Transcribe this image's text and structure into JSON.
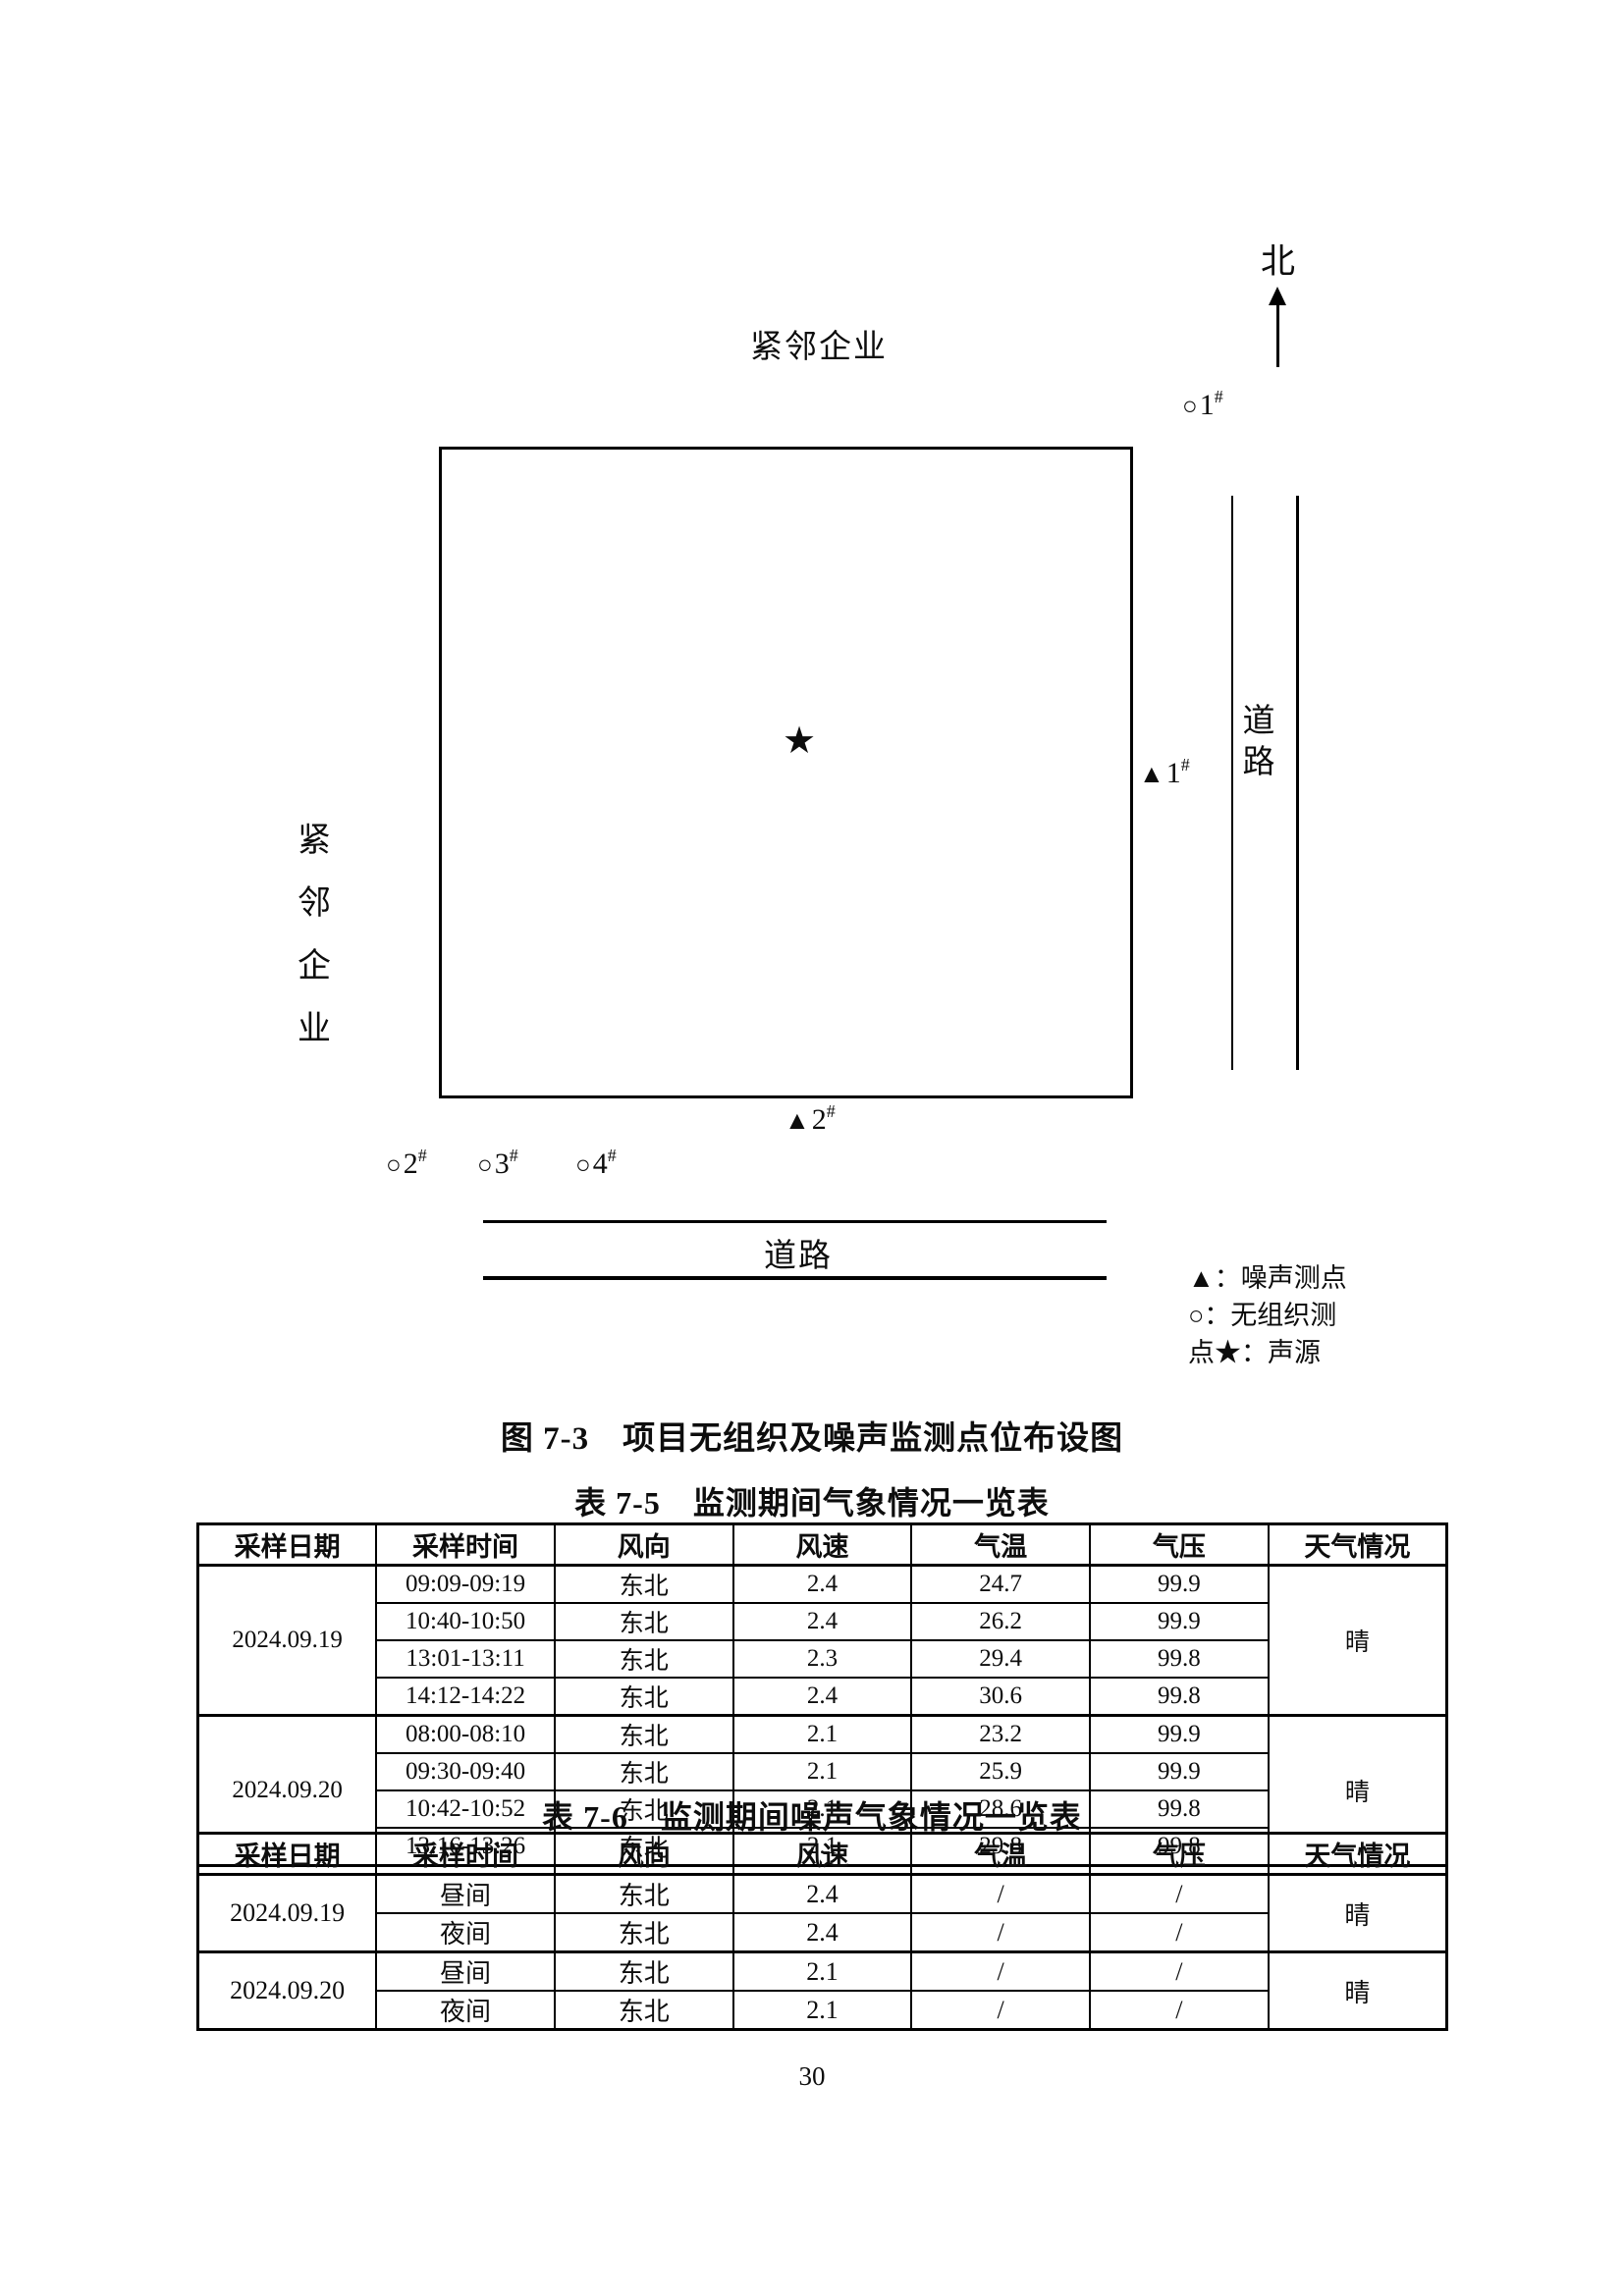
{
  "diagram": {
    "north_label": "北",
    "top_neighbor": "紧邻企业",
    "left_neighbor": "紧邻企业",
    "right_road": "道路",
    "bottom_road": "道路",
    "source_symbol": "★",
    "markers": {
      "o1": {
        "symbol": "○",
        "label": "1",
        "sup": "#"
      },
      "n1": {
        "symbol": "▲",
        "label": "1",
        "sup": "#"
      },
      "n2": {
        "symbol": "▲",
        "label": "2",
        "sup": "#"
      },
      "o2": {
        "symbol": "○",
        "label": "2",
        "sup": "#"
      },
      "o3": {
        "symbol": "○",
        "label": "3",
        "sup": "#"
      },
      "o4": {
        "symbol": "○",
        "label": "4",
        "sup": "#"
      }
    },
    "legend": {
      "line1": "▲：噪声测点",
      "line2": "○：无组织测",
      "line3": "点★：声源"
    }
  },
  "figure_caption": "图 7-3　项目无组织及噪声监测点位布设图",
  "table_7_5": {
    "title": "表 7-5　监测期间气象情况一览表",
    "headers": [
      "采样日期",
      "采样时间",
      "风向",
      "风速",
      "气温",
      "气压",
      "天气情况"
    ],
    "groups": [
      {
        "date": "2024.09.19",
        "weather": "晴",
        "rows": [
          [
            "09:09-09:19",
            "东北",
            "2.4",
            "24.7",
            "99.9"
          ],
          [
            "10:40-10:50",
            "东北",
            "2.4",
            "26.2",
            "99.9"
          ],
          [
            "13:01-13:11",
            "东北",
            "2.3",
            "29.4",
            "99.8"
          ],
          [
            "14:12-14:22",
            "东北",
            "2.4",
            "30.6",
            "99.8"
          ]
        ]
      },
      {
        "date": "2024.09.20",
        "weather": "晴",
        "rows": [
          [
            "08:00-08:10",
            "东北",
            "2.1",
            "23.2",
            "99.9"
          ],
          [
            "09:30-09:40",
            "东北",
            "2.1",
            "25.9",
            "99.9"
          ],
          [
            "10:42-10:52",
            "东北",
            "2.1",
            "28.6",
            "99.8"
          ],
          [
            "13:16-13:26",
            "东北",
            "2.1",
            "29.8",
            "99.8"
          ]
        ]
      }
    ]
  },
  "table_7_6": {
    "title": "表 7-6　监测期间噪声气象情况一览表",
    "headers": [
      "采样日期",
      "采样时间",
      "风向",
      "风速",
      "气温",
      "气压",
      "天气情况"
    ],
    "groups": [
      {
        "date": "2024.09.19",
        "weather": "晴",
        "rows": [
          [
            "昼间",
            "东北",
            "2.4",
            "/",
            "/"
          ],
          [
            "夜间",
            "东北",
            "2.4",
            "/",
            "/"
          ]
        ]
      },
      {
        "date": "2024.09.20",
        "weather": "晴",
        "rows": [
          [
            "昼间",
            "东北",
            "2.1",
            "/",
            "/"
          ],
          [
            "夜间",
            "东北",
            "2.1",
            "/",
            "/"
          ]
        ]
      }
    ]
  },
  "page": {
    "number": "30"
  }
}
